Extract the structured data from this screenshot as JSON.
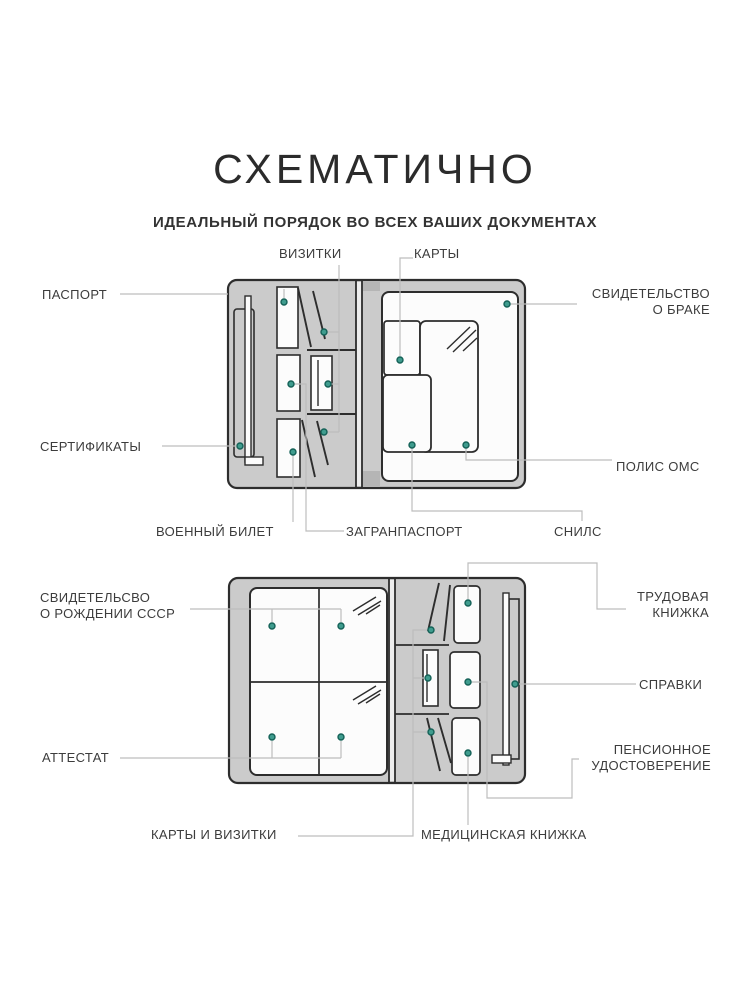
{
  "title": "СХЕМАТИЧНО",
  "subtitle": "ИДЕАЛЬНЫЙ ПОРЯДОК ВО ВСЕХ ВАШИХ ДОКУМЕНТАХ",
  "top_diagram": {
    "passport": "ПАСПОРТ",
    "certificates": "СЕРТИФИКАТЫ",
    "business_cards": "ВИЗИТКИ",
    "cards": "КАРТЫ",
    "marriage_l1": "СВИДЕТЕЛЬСТВО",
    "marriage_l2": "О БРАКЕ",
    "oms_policy": "ПОЛИС ОМС",
    "snils": "СНИЛС",
    "foreign_passport": "ЗАГРАНПАСПОРТ",
    "military_id": "ВОЕННЫЙ БИЛЕТ"
  },
  "bottom_diagram": {
    "birth_cert_l1": "СВИДЕТЕЛЬСВО",
    "birth_cert_l2": "О РОЖДЕНИИ СССР",
    "attestat": "АТТЕСТАТ",
    "work_book_l1": "ТРУДОВАЯ",
    "work_book_l2": "КНИЖКА",
    "spravki": "СПРАВКИ",
    "pension_l1": "ПЕНСИОННОЕ",
    "pension_l2": "УДОСТОВЕРЕНИЕ",
    "medical_book": "МЕДИЦИНСКАЯ КНИЖКА",
    "cards_and_business_cards": "КАРТЫ И ВИЗИТКИ"
  },
  "colors": {
    "cover": "#cbcbcb",
    "outline": "#2d2d2d",
    "page": "#fcfcfc",
    "leader": "#bdbdbd",
    "marker": "#3f9c8e",
    "marker_border": "#146157",
    "text": "#3c3c3c"
  }
}
